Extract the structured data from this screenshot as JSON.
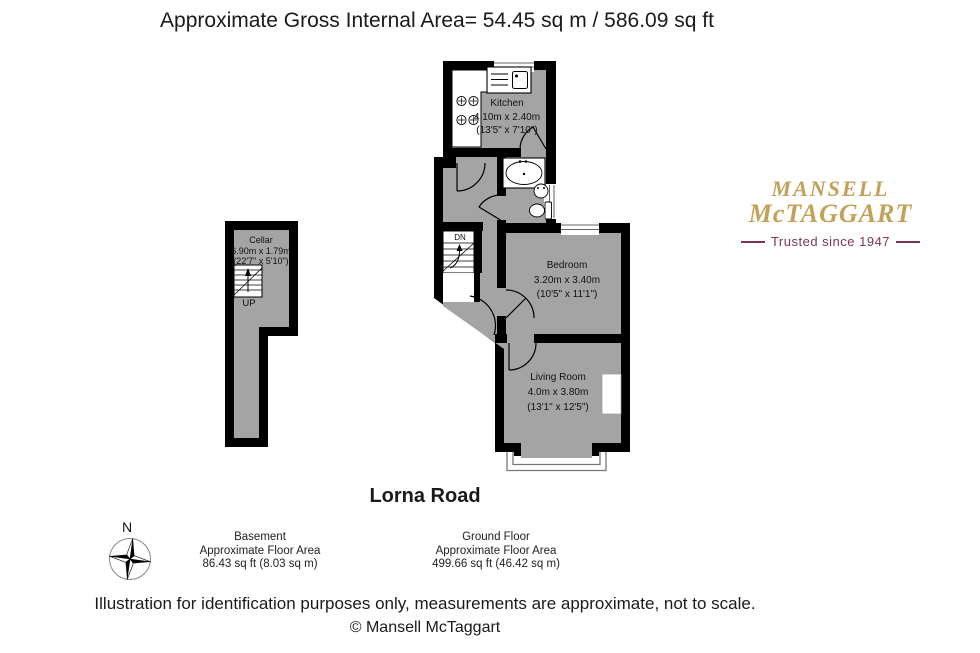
{
  "title": "Approximate Gross Internal Area= 54.45 sq m / 586.09 sq ft",
  "plan": {
    "street": "Lorna Road",
    "rooms": {
      "kitchen": {
        "name": "Kitchen",
        "metric": "4.10m x 2.40m",
        "imperial": "(13'5\" x 7'10\")"
      },
      "bedroom": {
        "name": "Bedroom",
        "metric": "3.20m x 3.40m",
        "imperial": "(10'5\" x 11'1\")"
      },
      "living_room": {
        "name": "Living Room",
        "metric": "4.0m x 3.80m",
        "imperial": "(13'1\" x 12'5\")"
      },
      "cellar": {
        "name": "Cellar",
        "metric": "6.90m x 1.79m",
        "imperial": "(22'7\" x 5'10\")"
      }
    },
    "stairs": {
      "up": "UP",
      "down": "DN"
    },
    "compass_north": "N"
  },
  "floors": {
    "basement": {
      "name": "Basement",
      "area_label": "Approximate Floor Area",
      "area": "86.43 sq ft (8.03 sq m)"
    },
    "ground": {
      "name": "Ground Floor",
      "area_label": "Approximate Floor Area",
      "area": "499.66 sq ft (46.42 sq m)"
    }
  },
  "branding": {
    "name_line1": "MANSELL",
    "name_line2": "McTAGGART",
    "tagline": "Trusted since 1947"
  },
  "footer": {
    "disclaimer": "Illustration for identification purposes only, measurements are approximate, not to scale.",
    "copyright": "© Mansell McTaggart"
  },
  "colors": {
    "floor_fill": "#A4A4A4",
    "wall": "#000000",
    "brand_gold": "#C2A158",
    "brand_maroon": "#7E3450"
  }
}
